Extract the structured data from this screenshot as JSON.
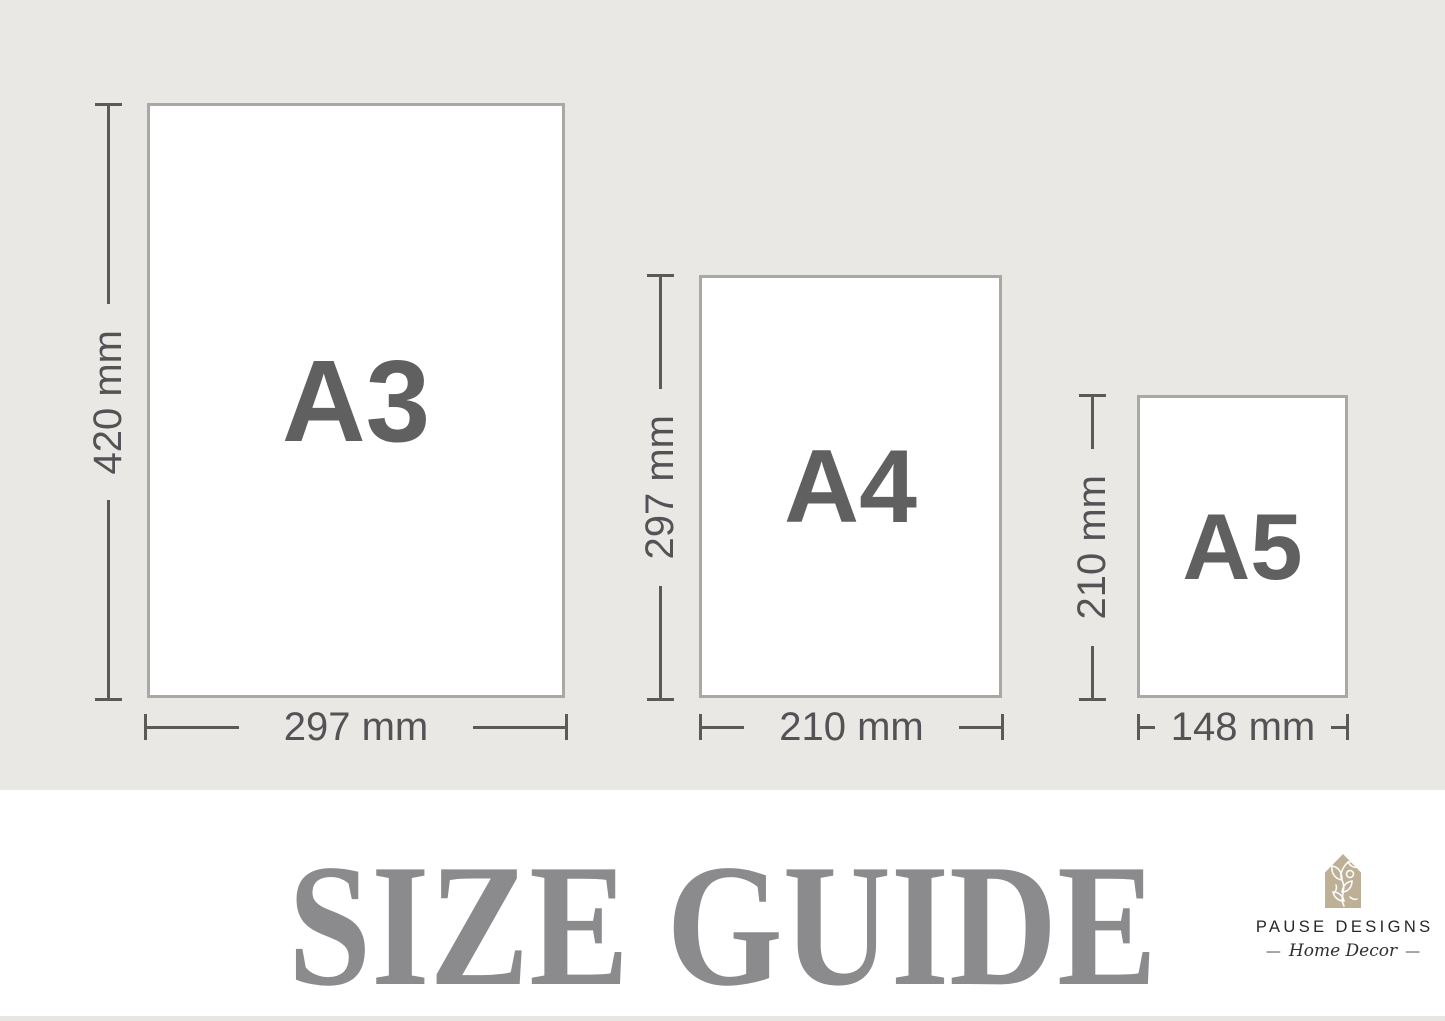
{
  "title": "SIZE GUIDE",
  "sizes": [
    {
      "name": "A3",
      "height": "420 mm",
      "width": "297 mm"
    },
    {
      "name": "A4",
      "height": "297 mm",
      "width": "210 mm"
    },
    {
      "name": "A5",
      "height": "210 mm",
      "width": "148 mm"
    }
  ],
  "brand": {
    "name": "PAUSE DESIGNS",
    "tagline": "Home Decor",
    "dash": "—",
    "icon": "house-botanical-icon",
    "icon_color": "#beb097"
  },
  "colors": {
    "background": "#e9e8e5",
    "paper_fill": "#ffffff",
    "paper_border": "#a9a8a5",
    "dimension_lines": "#5b5a57",
    "dimension_text": "#535255",
    "size_label": "#606060",
    "title_text": "#8b8a8d",
    "brand_text": "#262626",
    "footer_background": "#ffffff"
  }
}
